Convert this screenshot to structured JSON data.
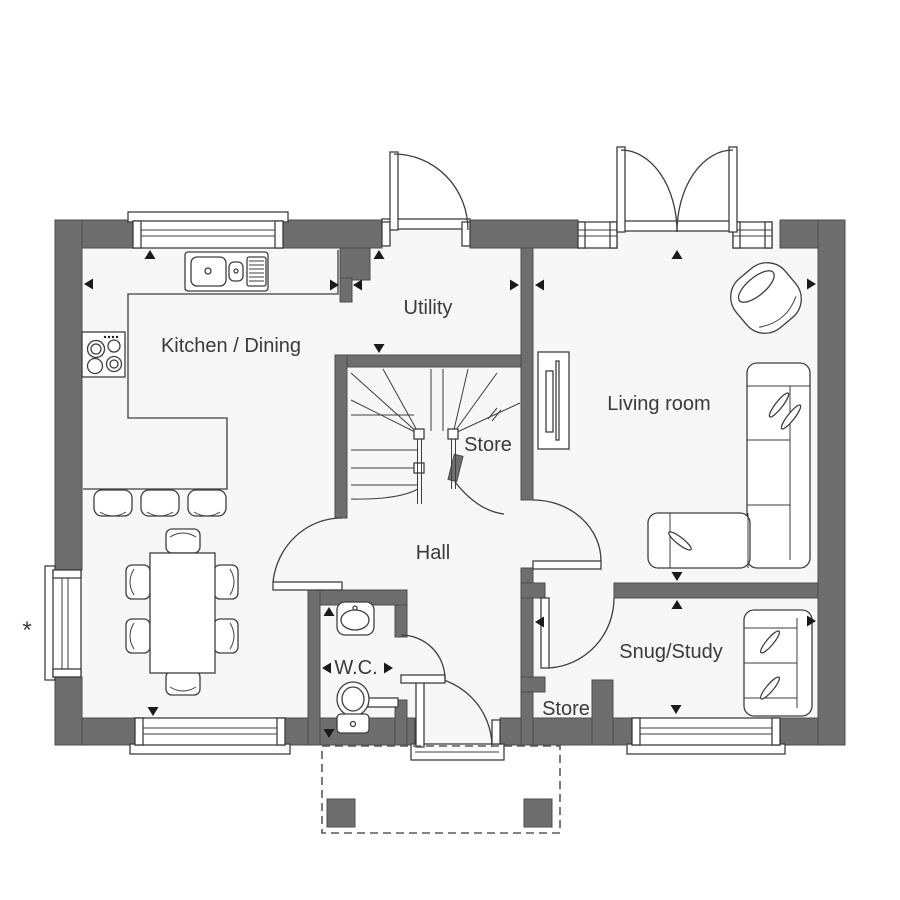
{
  "rooms": {
    "kitchen_dining": "Kitchen / Dining",
    "utility": "Utility",
    "living_room": "Living room",
    "store_under_stairs": "Store",
    "hall": "Hall",
    "wc": "W.C.",
    "store_hall": "Store",
    "snug_study": "Snug/Study"
  },
  "annotations": {
    "window_note": "*"
  },
  "colors": {
    "wall": "#6e6e6e",
    "line": "#3e3e3e",
    "text": "#3a3a3a",
    "floor": "#f7f7f7",
    "background": "#ffffff",
    "arrow": "#1a1a1a"
  }
}
